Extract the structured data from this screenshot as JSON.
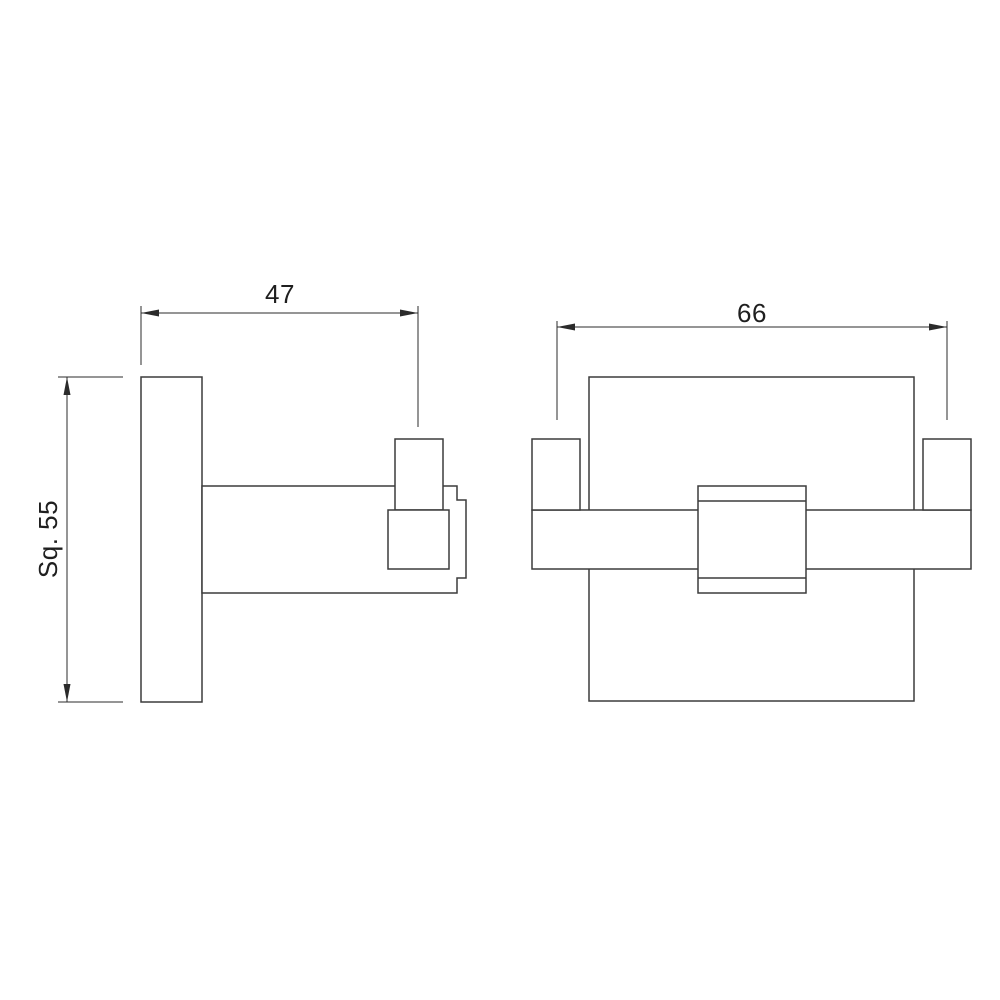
{
  "drawing": {
    "kind": "technical-dimension-drawing",
    "subject": "square double robe hook, side view and front view",
    "background_color": "#ffffff",
    "object_line_color": "#3c3c3c",
    "dimension_line_color": "#2b2b2b",
    "text_color": "#1f1f1f",
    "dimensions": {
      "projection_depth": "47",
      "hook_pitch": "66",
      "faceplate_square": "Sq. 55"
    }
  }
}
